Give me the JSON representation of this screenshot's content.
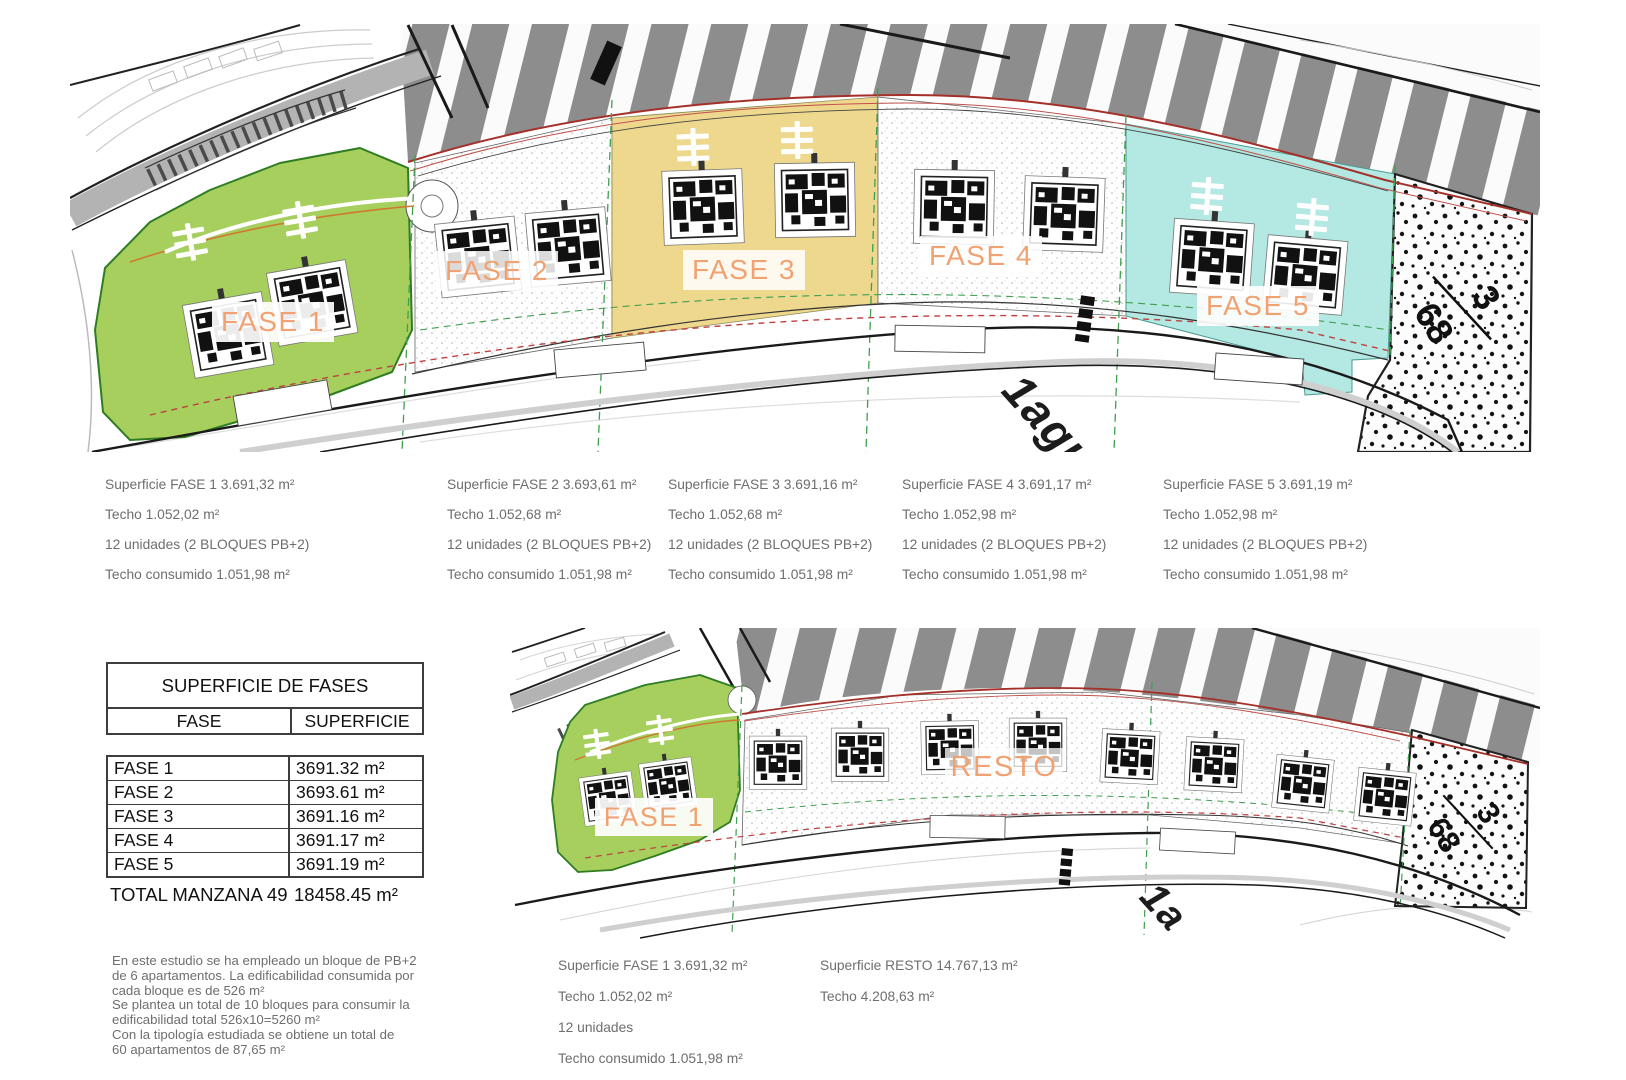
{
  "colors": {
    "fase1_green": "#a6cf5e",
    "fase3_yellow": "#eed88d",
    "fase5_cyan": "#b4e8e2",
    "label_orange": "#f1a273",
    "stripe_gray": "#8d8d8d",
    "boundary_red": "#a5302a",
    "dash_green": "#3f9f4f"
  },
  "top_plan": {
    "fase_labels": [
      "FASE 1",
      "FASE 2",
      "FASE 3",
      "FASE 4",
      "FASE 5"
    ],
    "parcel_num": "3",
    "parcel_den": "68",
    "road_label": "1agu"
  },
  "bottom_plan": {
    "fase1_label": "FASE 1",
    "resto_label": "RESTO",
    "parcel_num": "3",
    "parcel_den": "68",
    "road_label": "1a"
  },
  "phase_info": [
    {
      "superficie": "Superficie FASE 1  3.691,32 m²",
      "techo": "Techo 1.052,02 m²",
      "unidades": "12 unidades  (2 BLOQUES PB+2)",
      "consumido": "Techo consumido 1.051,98 m²"
    },
    {
      "superficie": "Superficie FASE 2  3.693,61 m²",
      "techo": "Techo 1.052,68 m²",
      "unidades": "12 unidades  (2 BLOQUES PB+2)",
      "consumido": "Techo consumido 1.051,98 m²"
    },
    {
      "superficie": "Superficie FASE 3  3.691,16 m²",
      "techo": "Techo 1.052,68 m²",
      "unidades": "12 unidades  (2 BLOQUES PB+2)",
      "consumido": "Techo consumido 1.051,98 m²"
    },
    {
      "superficie": "Superficie FASE 4  3.691,17 m²",
      "techo": "Techo 1.052,98 m²",
      "unidades": "12 unidades  (2 BLOQUES PB+2)",
      "consumido": "Techo consumido 1.051,98 m²"
    },
    {
      "superficie": "Superficie FASE 5  3.691,19 m²",
      "techo": "Techo 1.052,98 m²",
      "unidades": "12 unidades  (2 BLOQUES PB+2)",
      "consumido": "Techo consumido 1.051,98 m²"
    }
  ],
  "table": {
    "title": "SUPERFICIE DE FASES",
    "col_fase": "FASE",
    "col_superficie": "SUPERFICIE",
    "rows": [
      {
        "fase": "FASE 1",
        "superficie": "3691.32 m²"
      },
      {
        "fase": "FASE 2",
        "superficie": "3693.61 m²"
      },
      {
        "fase": "FASE 3",
        "superficie": "3691.16 m²"
      },
      {
        "fase": "FASE 4",
        "superficie": "3691.17 m²"
      },
      {
        "fase": "FASE 5",
        "superficie": "3691.19 m²"
      }
    ],
    "total_label": "TOTAL MANZANA 49",
    "total_value": "18458.45 m²"
  },
  "notes": "En este estudio se ha empleado un bloque de PB+2\nde 6 apartamentos. La edificabilidad consumida por\ncada bloque es de 526 m²\nSe plantea un total de 10 bloques para consumir  la\nedificabilidad total 526x10=5260 m²\nCon la tipología estudiada se obtiene un total de\n60 apartamentos de 87,65 m²",
  "bottom_info": {
    "fase1": {
      "superficie": "Superficie FASE 1  3.691,32 m²",
      "techo": "Techo 1.052,02 m²",
      "unidades": "12 unidades",
      "consumido": "Techo consumido 1.051,98 m²"
    },
    "resto": {
      "superficie": "Superficie RESTO  14.767,13 m²",
      "techo": "Techo 4.208,63 m²"
    }
  }
}
